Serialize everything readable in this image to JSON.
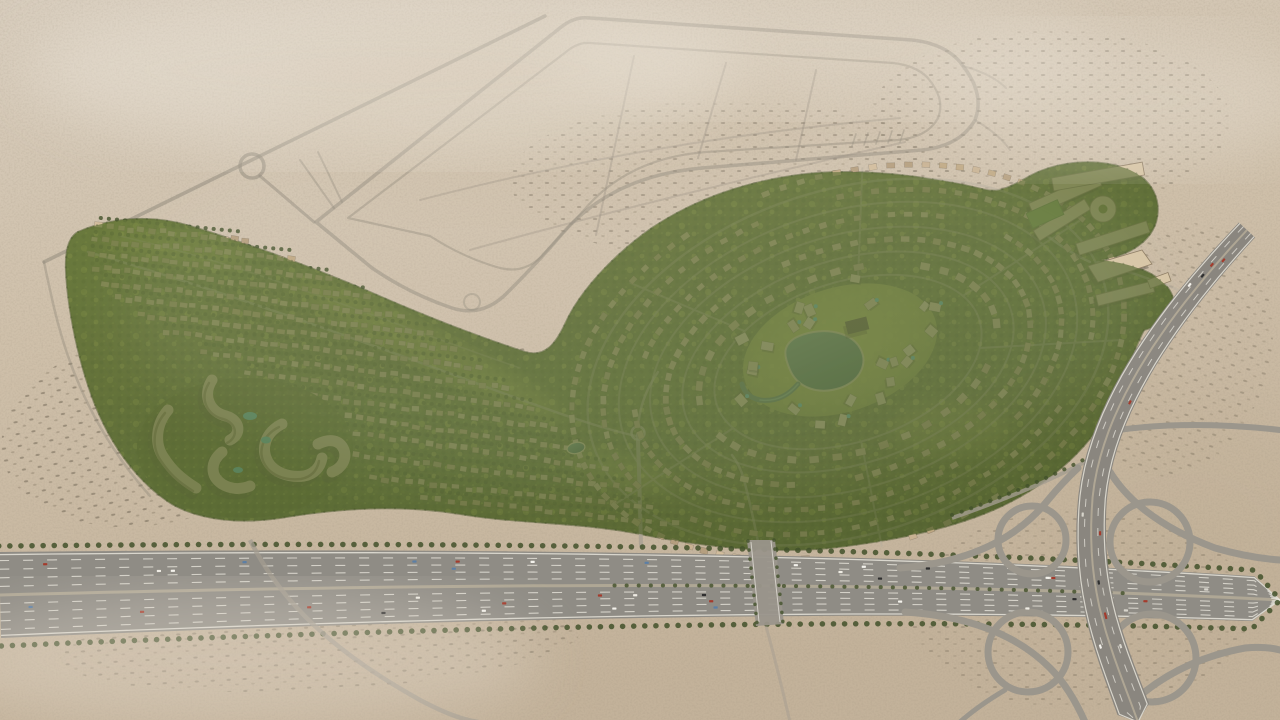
{
  "meta": {
    "title": "Aerial masterplan render",
    "description": "Aerial 3D render of a desert master-planned residential community: curved rows of townhouses, concentric villa rings around a central park with a lake, a mid-rise apartment cluster, a school campus, ghost roads of future plots in the sand, a multi-lane perimeter highway and a cloverleaf interchange."
  },
  "palette": {
    "sand": "#cfc0aa",
    "sand_light": "#ddd3c4",
    "sand_dark": "#b7a68c",
    "ghost_road": "#928a7b",
    "site_green_dark": "#4c5a2b",
    "site_green": "#66753a",
    "site_green_light": "#8b9c4a",
    "canopy_yellow": "#c8d164",
    "asphalt": "#8f8c85",
    "asphalt_light": "#a39c90",
    "lane_mark": "#ebe8df",
    "median": "#b3aa97",
    "tree_dark": "#42512a",
    "water": "#3f6f63",
    "water_light": "#7fb0a0",
    "beach": "#d9cda9",
    "pool": "#4fc0cf",
    "roof_shadow": "#3a3528",
    "campus_roof": "#d7c5a5",
    "field_green": "#77a04a"
  },
  "scene": {
    "seed": 7,
    "roof_colors": [
      "#c8b292",
      "#bfa883",
      "#d2bd9d",
      "#b59f7f",
      "#cdb697"
    ],
    "inner_roof_colors": [
      "#ddcbab",
      "#e4d4b6",
      "#d5c3a2"
    ],
    "villa_rows": [
      {
        "x1": 100,
        "y1": 226,
        "x2": 245,
        "y2": 240,
        "n": 15
      },
      {
        "x1": 95,
        "y1": 240,
        "x2": 290,
        "y2": 258,
        "n": 20
      },
      {
        "x1": 92,
        "y1": 254,
        "x2": 330,
        "y2": 278,
        "n": 24
      },
      {
        "x1": 96,
        "y1": 268,
        "x2": 368,
        "y2": 296,
        "n": 27
      },
      {
        "x1": 105,
        "y1": 283,
        "x2": 400,
        "y2": 315,
        "n": 29
      },
      {
        "x1": 118,
        "y1": 298,
        "x2": 430,
        "y2": 333,
        "n": 30
      },
      {
        "x1": 140,
        "y1": 315,
        "x2": 455,
        "y2": 350,
        "n": 30
      },
      {
        "x1": 165,
        "y1": 332,
        "x2": 480,
        "y2": 368,
        "n": 30
      },
      {
        "x1": 205,
        "y1": 352,
        "x2": 505,
        "y2": 388,
        "n": 28
      },
      {
        "x1": 248,
        "y1": 372,
        "x2": 530,
        "y2": 408,
        "n": 26
      },
      {
        "x1": 278,
        "y1": 392,
        "x2": 555,
        "y2": 428,
        "n": 25
      },
      {
        "x1": 312,
        "y1": 412,
        "x2": 580,
        "y2": 448,
        "n": 24
      },
      {
        "x1": 346,
        "y1": 432,
        "x2": 605,
        "y2": 468,
        "n": 23
      },
      {
        "x1": 356,
        "y1": 455,
        "x2": 628,
        "y2": 488,
        "n": 24
      },
      {
        "x1": 372,
        "y1": 478,
        "x2": 650,
        "y2": 508,
        "n": 24
      },
      {
        "x1": 425,
        "y1": 498,
        "x2": 675,
        "y2": 524,
        "n": 21
      }
    ],
    "villa_rings": {
      "cx": 848,
      "cy": 362,
      "rot": -18,
      "rings": [
        {
          "rx": 284,
          "ry": 186,
          "n": 96,
          "s": 7,
          "gaps": [
            100,
            255
          ]
        },
        {
          "rx": 252,
          "ry": 162,
          "n": 88,
          "s": 7,
          "gaps": [
            30,
            150,
            270
          ]
        },
        {
          "rx": 220,
          "ry": 138,
          "n": 78,
          "s": 7,
          "gaps": [
            60,
            200,
            320
          ]
        },
        {
          "rx": 188,
          "ry": 114,
          "n": 66,
          "s": 7.5,
          "gaps": [
            110,
            250
          ]
        },
        {
          "rx": 154,
          "ry": 90,
          "n": 40,
          "s": 9,
          "gaps": [
            20,
            170,
            300
          ]
        }
      ]
    },
    "inner_villas": {
      "cx": 840,
      "cy": 352,
      "rx": 118,
      "ry": 72,
      "n": 24,
      "lake_x": 826,
      "lake_y": 363,
      "lake_r": 40
    },
    "highway": {
      "median_path": "M 0,595 C 450,583 900,580 1280,600",
      "half_left": 43,
      "half_right": 22,
      "lane_fracs": [
        -0.8,
        -0.6,
        -0.4,
        -0.2,
        0.2,
        0.4,
        0.6,
        0.8
      ],
      "edge_frac": 0.94
    },
    "diagonal": {
      "path": "M 1247,230 C 1165,318 1098,412 1092,505 C 1086,598 1112,650 1138,722",
      "half_start": 11,
      "half_end": 17,
      "lane_fracs": [
        -0.45,
        0.45
      ],
      "edge_frac": 0.88
    },
    "cars": {
      "highway_count": 36,
      "diagonal_count": 12,
      "colors": [
        "#f4f2ec",
        "#2f2f2f",
        "#a43b2c",
        "#5b7fa6",
        "#d8d5cc",
        "#efece4"
      ]
    }
  }
}
